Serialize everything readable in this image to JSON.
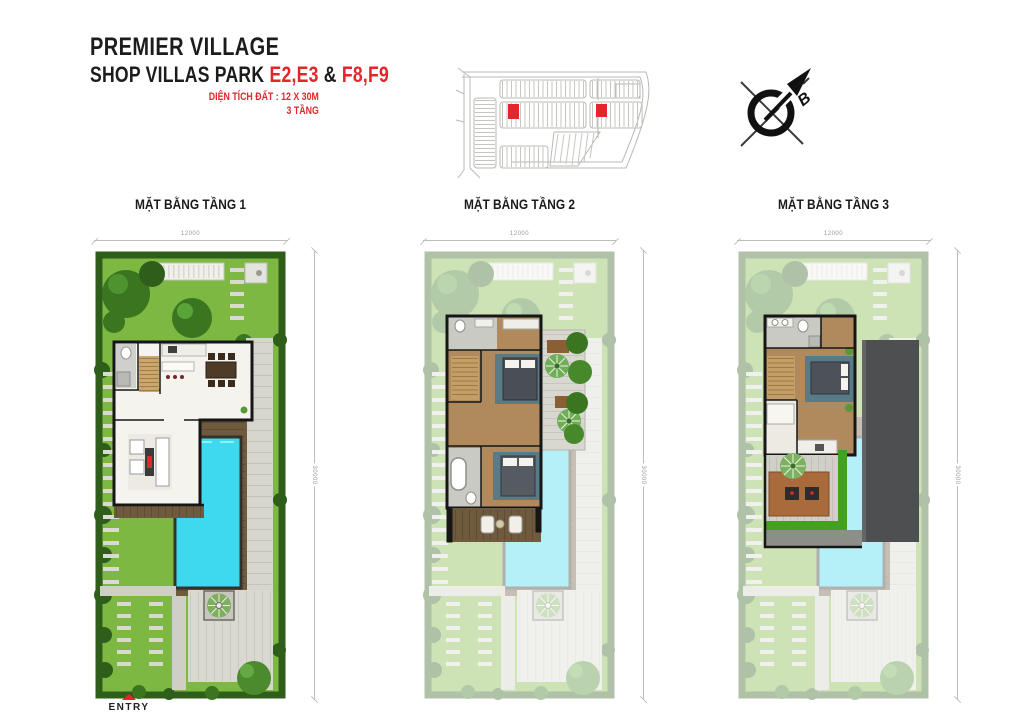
{
  "palette": {
    "accent": "#e2262a",
    "wall": "#161616",
    "map-line": "#b9b9b4",
    "lawn": "#7db842",
    "hedge": "#2f5e1b",
    "tree": "#39761f",
    "pool": "#3ed8ef",
    "deck": "#6f5a3e",
    "wood": "#b08a5c",
    "roof": "#4e4f51"
  },
  "header": {
    "title": "PREMIER VILLAGE",
    "subtitle_prefix": "SHOP VILLAS PARK",
    "subtitle_red1": "E2,E3",
    "subtitle_amp": "&",
    "subtitle_red2": "F8,F9",
    "area_line": "DIỆN TÍCH ĐẤT : 12 X 30M",
    "floors_line": "3 TẦNG"
  },
  "compass": {
    "north_label": "B"
  },
  "plans": [
    {
      "label": "MẶT BẰNG TẦNG 1",
      "dim_width": "12000",
      "dim_height": "30000"
    },
    {
      "label": "MẶT BẰNG TẦNG 2",
      "dim_width": "12000",
      "dim_height": "30000"
    },
    {
      "label": "MẶT BẰNG TẦNG 3",
      "dim_width": "12000",
      "dim_height": "30000"
    }
  ],
  "entry_label": "ENTRY"
}
